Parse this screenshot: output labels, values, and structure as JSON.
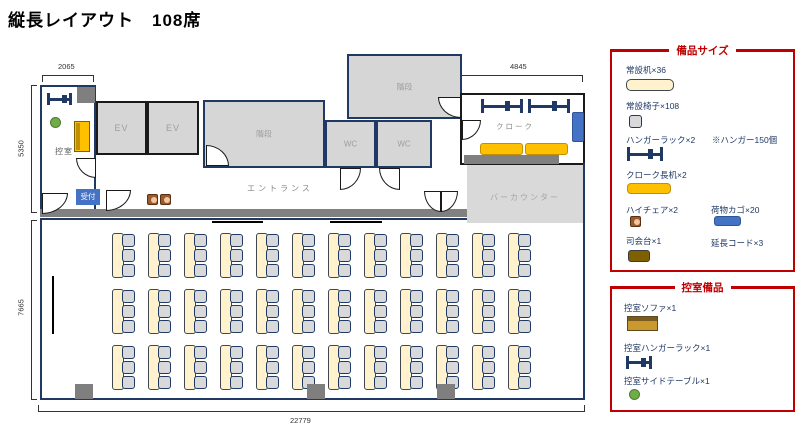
{
  "title": "縦長レイアウト　108席",
  "floor": {
    "rooms": {
      "hikae": "控室",
      "ev1": "EV",
      "ev2": "EV",
      "stairs1": "階段",
      "stairs2": "階段",
      "wc1": "WC",
      "wc2": "WC",
      "entrance": "エントランス",
      "cloak": "クローク",
      "bar": "バーカウンター",
      "reception_badge": "受付"
    },
    "dimensions": {
      "hikae_width": "2065",
      "cloak_width": "4845",
      "upper_height": "5350",
      "hall_height": "7665",
      "total_width": "22779"
    },
    "hall": {
      "desk_rows": 3,
      "desk_cols": 12,
      "chairs_per_desk": 3,
      "total_desks": 36,
      "total_seats": 108
    }
  },
  "legend_equipment": {
    "title": "備品サイズ",
    "items": [
      {
        "label": "常設机×36",
        "icon": "desk-icon"
      },
      {
        "label": "常設椅子×108",
        "icon": "chair-icon"
      },
      {
        "label": "ハンガーラック×2",
        "note": "※ハンガー150個",
        "icon": "hanger-rack-icon"
      },
      {
        "label": "クローク長机×2",
        "icon": "cloak-table-icon"
      },
      {
        "label": "ハイチェア×2",
        "icon": "high-chair-icon"
      },
      {
        "label": "荷物カゴ×20",
        "icon": "luggage-basket-icon"
      },
      {
        "label": "司会台×1",
        "icon": "mc-stand-icon"
      },
      {
        "label": "延長コード×3",
        "icon": ""
      }
    ]
  },
  "legend_hikae": {
    "title": "控室備品",
    "items": [
      {
        "label": "控室ソファ×1",
        "icon": "sofa-icon"
      },
      {
        "label": "控室ハンガーラック×1",
        "icon": "hanger-rack-icon"
      },
      {
        "label": "控室サイドテーブル×1",
        "icon": "side-table-icon"
      }
    ]
  },
  "colors": {
    "wall_navy": "#1f3864",
    "legend_red": "#c00000",
    "desk_cream": "#fff2cc",
    "chair_gray": "#d9d9d9",
    "table_gold": "#ffc000",
    "basket_blue": "#4472c4",
    "side_table_green": "#70ad47",
    "room_gray": "#d6d6d6"
  }
}
